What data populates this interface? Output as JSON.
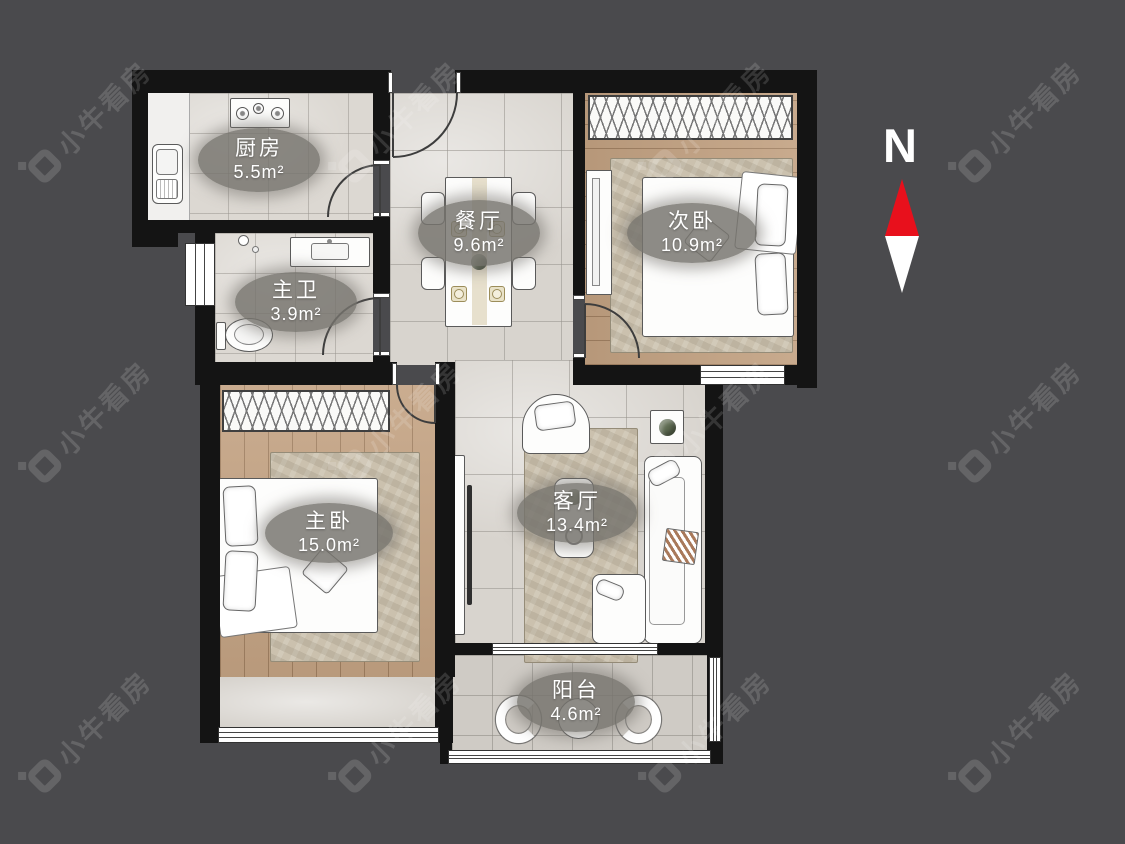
{
  "watermark": {
    "text": "小牛看房"
  },
  "compass": {
    "label": "N",
    "north_color": "#e8101c",
    "south_color": "#ffffff"
  },
  "rooms": [
    {
      "id": "kitchen",
      "name": "厨房",
      "area": "5.5m²"
    },
    {
      "id": "master-bath",
      "name": "主卫",
      "area": "3.9m²"
    },
    {
      "id": "dining-room",
      "name": "餐厅",
      "area": "9.6m²"
    },
    {
      "id": "second-bedroom",
      "name": "次卧",
      "area": "10.9m²"
    },
    {
      "id": "master-bedroom",
      "name": "主卧",
      "area": "15.0m²"
    },
    {
      "id": "living-room",
      "name": "客厅",
      "area": "13.4m²"
    },
    {
      "id": "balcony",
      "name": "阳台",
      "area": "4.6m²"
    }
  ]
}
